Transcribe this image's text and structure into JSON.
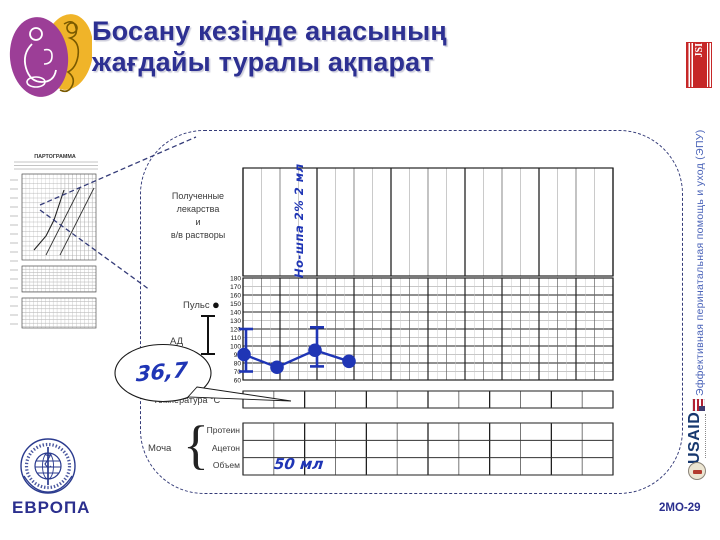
{
  "slide": {
    "title_line1": "Босану кезінде анасының",
    "title_line2": "жағдайы туралы ақпарат",
    "side_text": "Эффективная перинатальная помощь и уход (ЭПУ)",
    "jsi_label": "JSI",
    "usaid_label": "USAID",
    "who_region_label": "ЕВРОПА",
    "slide_code": "2МО-29"
  },
  "partograph": {
    "thumbnail_title": "ПАРТОГРАММА",
    "form": {
      "drugs_label_lines": [
        "Полученные",
        "лекарства",
        "и",
        "в/в растворы"
      ],
      "pulse_label": "Пульс",
      "pulse_marker": "●",
      "bp_label": "АД",
      "temperature_label": "Температура °С",
      "urine_label": "Моча",
      "urine_bracket": "{",
      "urine_rows": [
        "Протеин",
        "Ацетон",
        "Объем"
      ]
    },
    "annotations": {
      "drug_entry": "Но-шпа 2% 2 мл",
      "temperature_value": "36,7",
      "urine_volume": "50 мл"
    }
  },
  "chart_data": {
    "type": "line",
    "title": "Пульс и АД (фрагмент партограммы)",
    "ylabel": "",
    "ylim": [
      60,
      180
    ],
    "yticks": [
      180,
      170,
      160,
      150,
      140,
      130,
      120,
      110,
      100,
      90,
      80,
      70,
      60
    ],
    "grid": true,
    "legend_position": "left",
    "series": [
      {
        "name": "Пульс",
        "marker": "dot",
        "x": [
          1,
          2,
          3,
          4
        ],
        "values": [
          90,
          75,
          95,
          82
        ]
      },
      {
        "name": "АД систолическое",
        "marker": "error-bar-top",
        "x": [
          1,
          3
        ],
        "values": [
          120,
          122
        ]
      },
      {
        "name": "АД диастолическое",
        "marker": "error-bar-bottom",
        "x": [
          1,
          3
        ],
        "values": [
          70,
          76
        ]
      }
    ]
  },
  "colors": {
    "title": "#2d3092",
    "handwriting": "#1f35b5",
    "chart_line": "#1f35b5",
    "jsi_red": "#c62828",
    "usaid_navy": "#17386e",
    "who_navy": "#2a3a8e",
    "side_text_blue": "#4a63b8",
    "dashed_navy": "#343b78"
  }
}
